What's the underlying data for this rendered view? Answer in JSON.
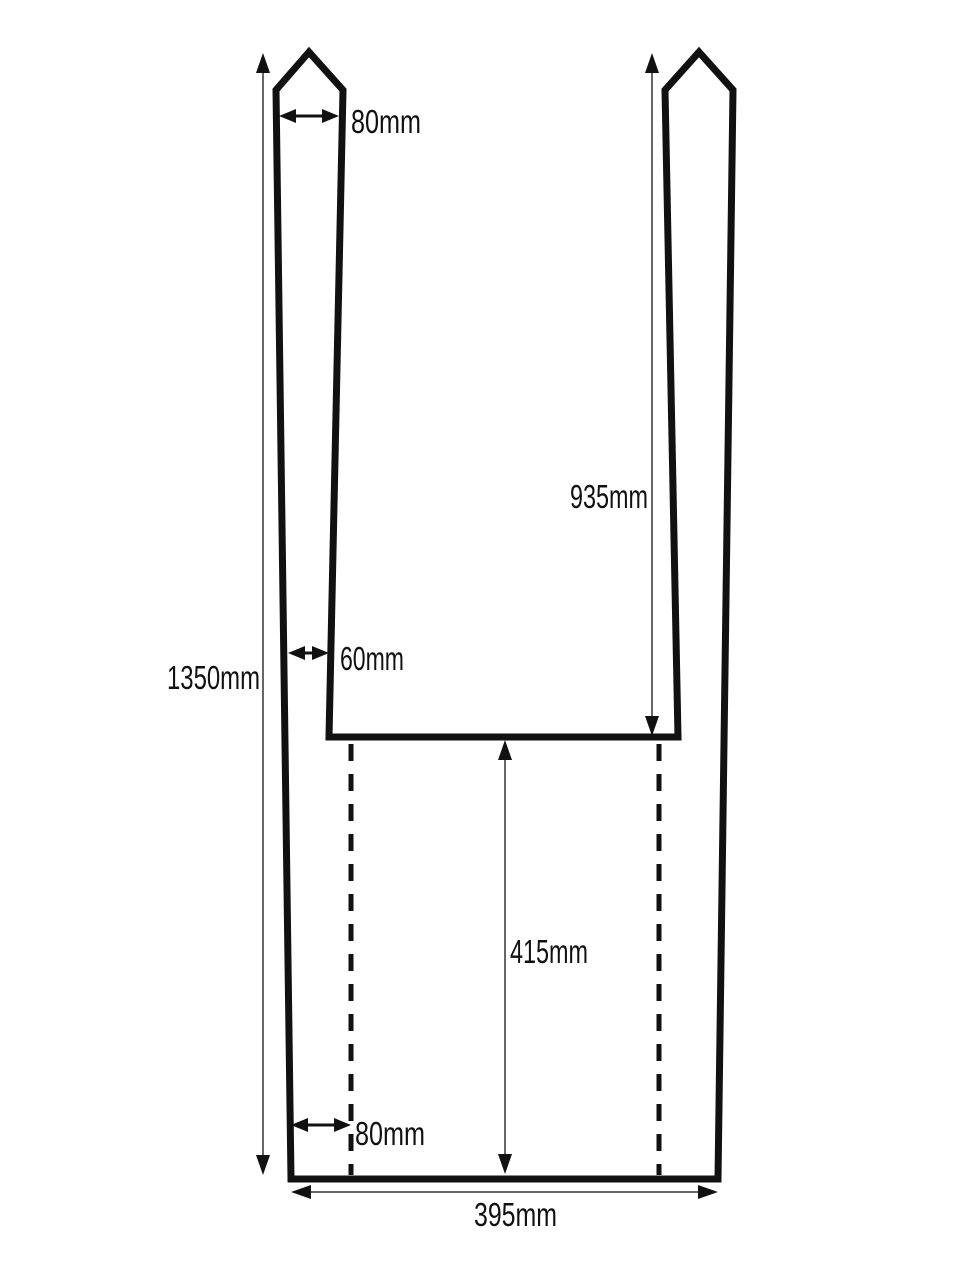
{
  "diagram": {
    "labels": {
      "strap_top_width": "80mm",
      "opening_depth": "935mm",
      "strap_bottom_width": "60mm",
      "total_height": "1350mm",
      "lower_section_height": "415mm",
      "bottom_side_inset": "80mm",
      "bottom_width": "395mm"
    },
    "colors": {
      "outline": "#111111",
      "dimension_line": "#666666",
      "text": "#111111",
      "background": "#ffffff"
    }
  }
}
